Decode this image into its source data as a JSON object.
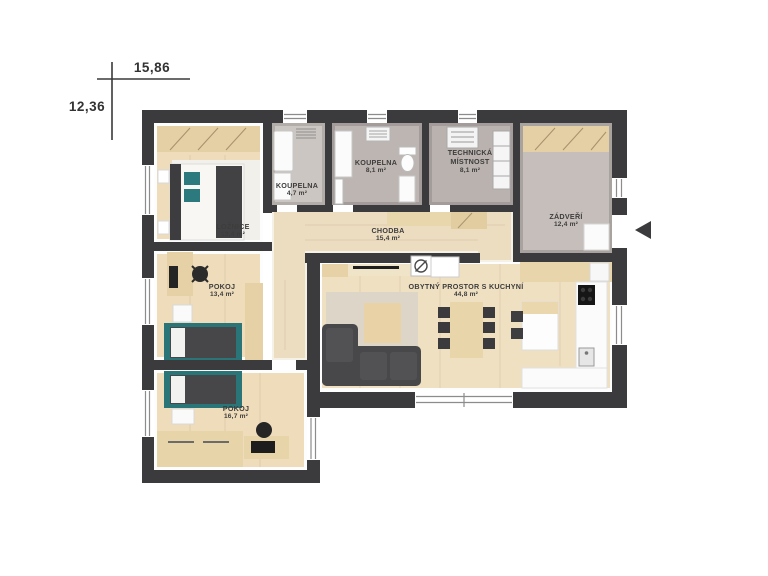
{
  "dimension_labels": {
    "width": "15,86",
    "height": "12,36"
  },
  "rooms": {
    "loznice": {
      "name": "LOŽNICE",
      "area": "13,4 m²"
    },
    "koupelna_small": {
      "name": "KOUPELNA",
      "area": "4,7 m²"
    },
    "koupelna_large": {
      "name": "KOUPELNA",
      "area": "8,1 m²"
    },
    "technicka": {
      "name": "TECHNICKÁ MÍSTNOST",
      "area": "8,1 m²"
    },
    "zadveri": {
      "name": "ZÁDVEŘÍ",
      "area": "12,4 m²"
    },
    "chodba": {
      "name": "CHODBA",
      "area": "15,4 m²"
    },
    "pokoj_13": {
      "name": "POKOJ",
      "area": "13,4 m²"
    },
    "pokoj_16": {
      "name": "POKOJ",
      "area": "16,7 m²"
    },
    "obytny": {
      "name": "OBYTNÝ PROSTOR S KUCHYNÍ",
      "area": "44,8 m²"
    }
  },
  "colors": {
    "wall": "#3b3b3d",
    "wood_floor": "#eedcbb",
    "wood_furniture": "#e6d1a6",
    "bathroom_floor": "#bdb5b2",
    "entry_floor": "#c5beba",
    "sofa_gray": "#48484a",
    "accent_teal": "#2c7a7d",
    "window_frame": "#8c8c8c"
  }
}
